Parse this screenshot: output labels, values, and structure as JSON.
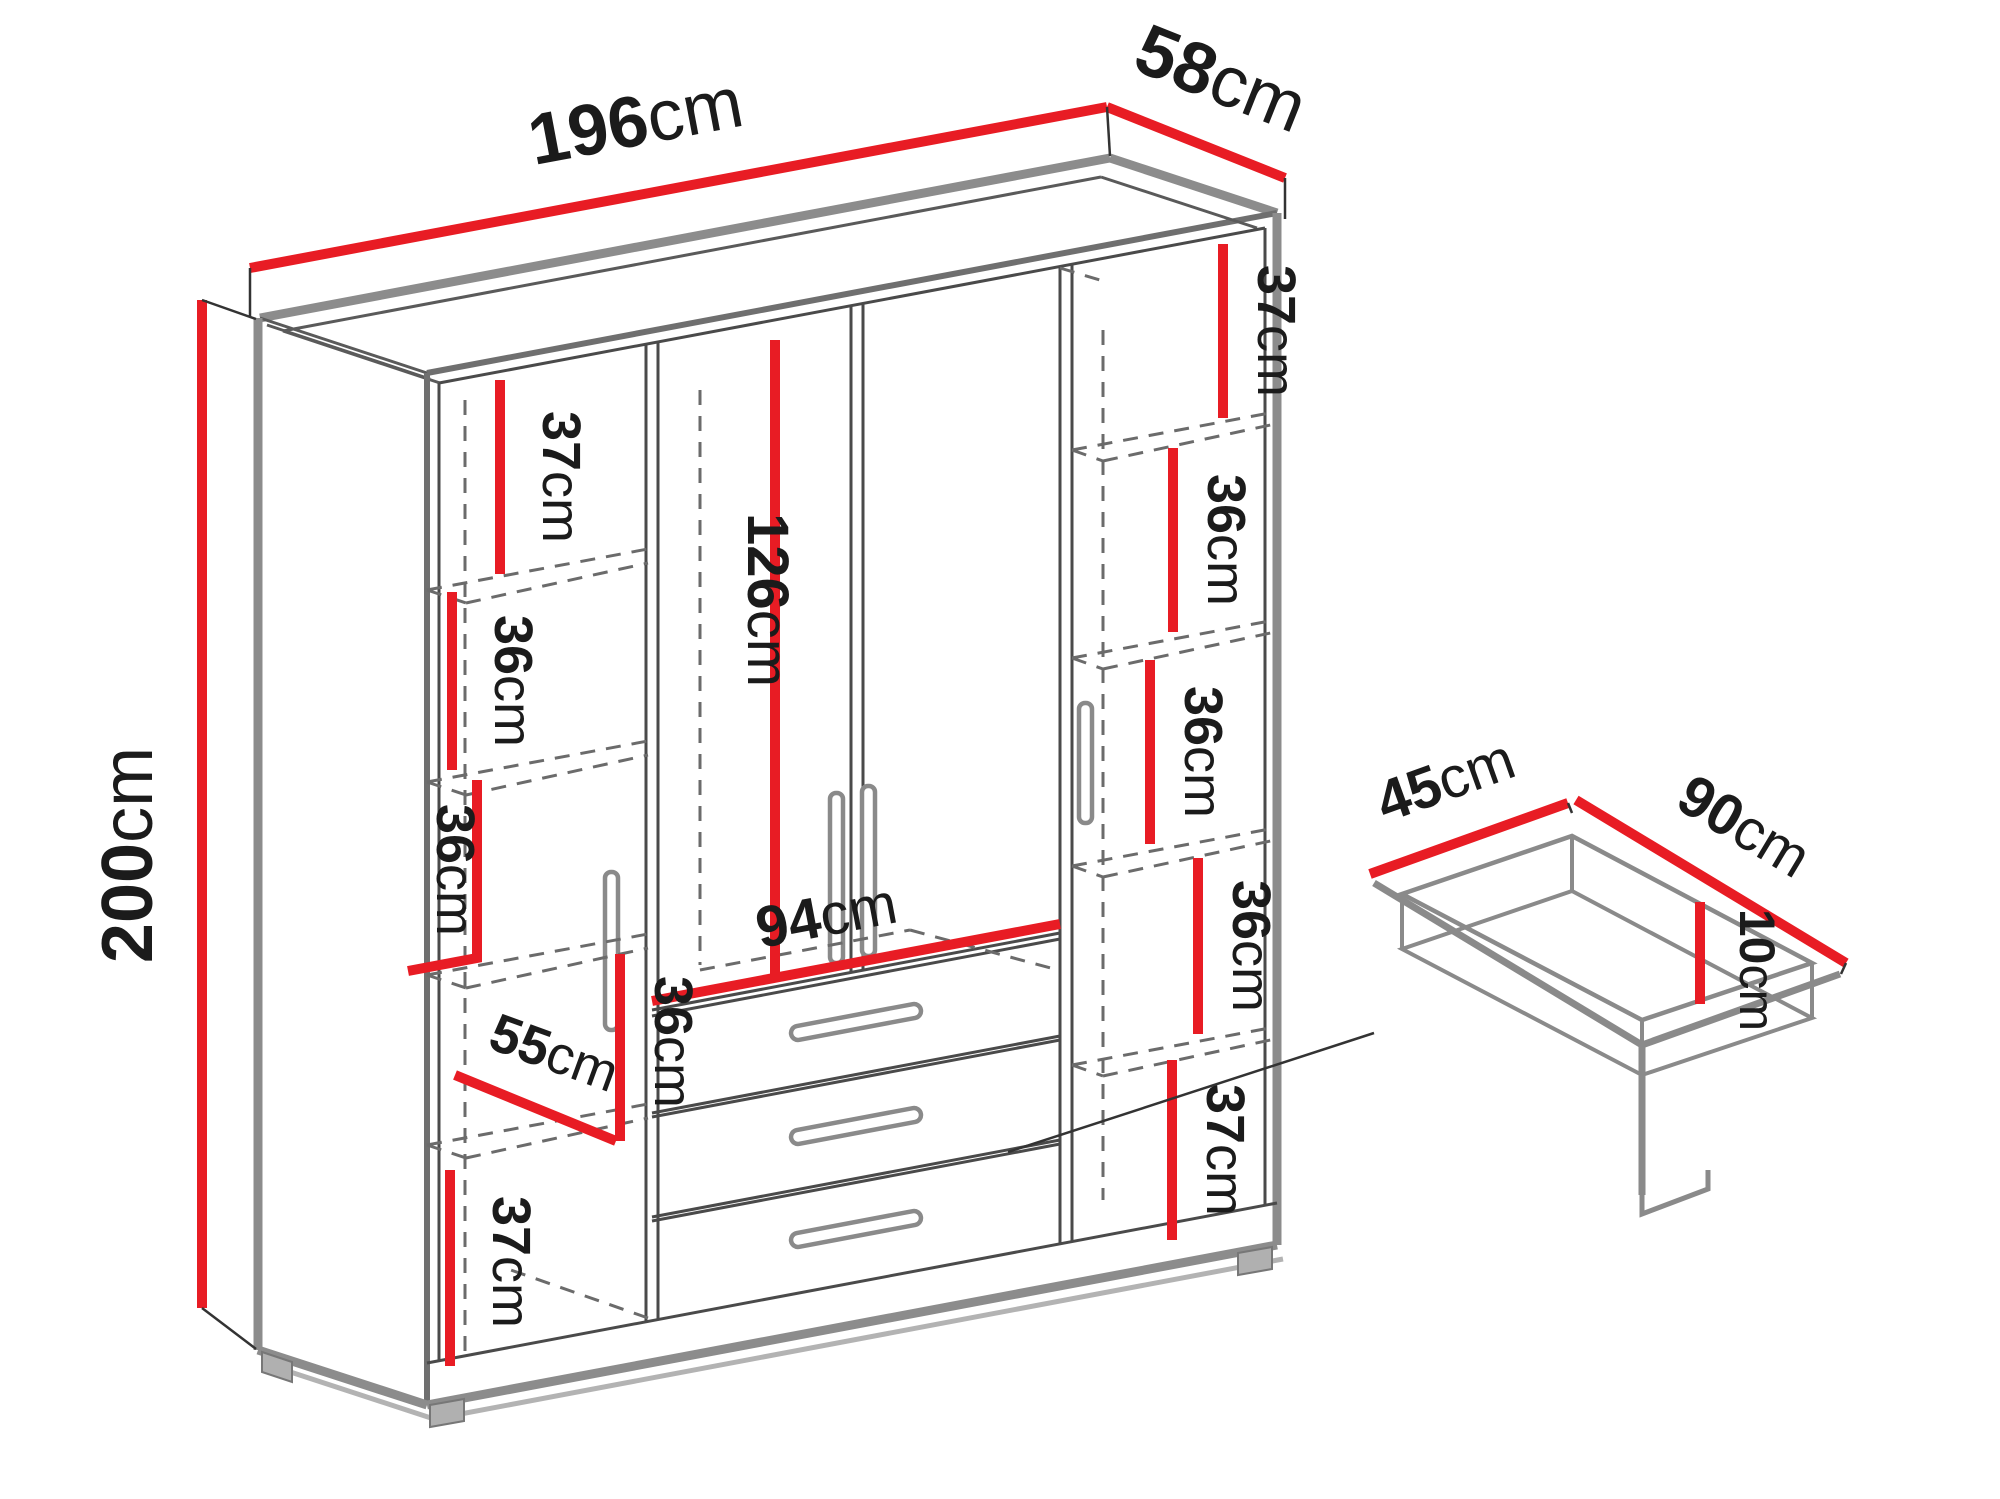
{
  "diagram_title": "Wardrobe dimension diagram",
  "units": "cm",
  "colors": {
    "dimension_line": "#e81c24",
    "structure_line": "#8c8c8c",
    "label_text": "#1b1b1b"
  },
  "wardrobe": {
    "width": {
      "value": "196",
      "unit": "cm"
    },
    "depth": {
      "value": "58",
      "unit": "cm"
    },
    "height": {
      "value": "200",
      "unit": "cm"
    },
    "hanging_section_height": {
      "value": "126",
      "unit": "cm"
    },
    "drawer_section_width": {
      "value": "94",
      "unit": "cm"
    },
    "interior_depth": {
      "value": "55",
      "unit": "cm"
    },
    "left_shelf_sections": [
      {
        "value": "37",
        "unit": "cm"
      },
      {
        "value": "36",
        "unit": "cm"
      },
      {
        "value": "36",
        "unit": "cm"
      },
      {
        "value": "36",
        "unit": "cm"
      },
      {
        "value": "37",
        "unit": "cm"
      }
    ],
    "right_shelf_sections": [
      {
        "value": "37",
        "unit": "cm"
      },
      {
        "value": "36",
        "unit": "cm"
      },
      {
        "value": "36",
        "unit": "cm"
      },
      {
        "value": "36",
        "unit": "cm"
      },
      {
        "value": "37",
        "unit": "cm"
      }
    ]
  },
  "drawer": {
    "depth": {
      "value": "45",
      "unit": "cm"
    },
    "width": {
      "value": "90",
      "unit": "cm"
    },
    "height": {
      "value": "10",
      "unit": "cm"
    }
  }
}
